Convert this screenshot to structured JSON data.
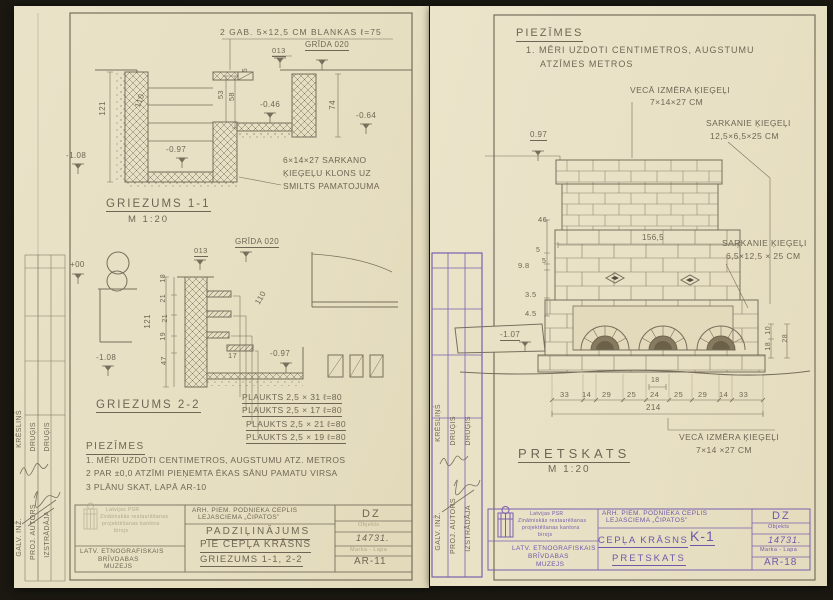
{
  "palette": {
    "paper": "#e9e1c6",
    "pencil": "#6f6655",
    "purple": "#7a5fae",
    "background": "#1a1811"
  },
  "left_sheet": {
    "labels": [
      {
        "n": "note-blankas",
        "t": "2 GAB. 5×12,5 CM BLANKAS ℓ=75",
        "x": 206,
        "y": 22,
        "s": 8.5,
        "ls": 1
      },
      {
        "n": "grida-level-label",
        "t": "GRĪDA 020",
        "x": 291,
        "y": 35,
        "s": 8,
        "u": 1
      },
      {
        "n": "dim-label",
        "t": "013",
        "x": 258,
        "y": 41,
        "s": 7.5,
        "u": 1
      },
      {
        "n": "dim-label",
        "t": "121",
        "x": 85,
        "y": 95,
        "s": 8,
        "cls": "v"
      },
      {
        "n": "dim-label",
        "t": "110",
        "x": 120,
        "y": 100,
        "s": 8,
        "r": -70
      },
      {
        "n": "level-label",
        "t": "-1.08",
        "x": 52,
        "y": 146,
        "s": 8
      },
      {
        "n": "level-label",
        "t": "-0.97",
        "x": 152,
        "y": 140,
        "s": 8
      },
      {
        "n": "dim-label",
        "t": "5",
        "x": 228,
        "y": 62,
        "s": 7,
        "cls": "v"
      },
      {
        "n": "dim-label",
        "t": "53",
        "x": 203,
        "y": 84,
        "s": 7.5,
        "cls": "v"
      },
      {
        "n": "dim-label",
        "t": "58",
        "x": 214,
        "y": 86,
        "s": 7.5,
        "cls": "v"
      },
      {
        "n": "level-label",
        "t": "-0.46",
        "x": 246,
        "y": 95,
        "s": 8
      },
      {
        "n": "dim-label",
        "t": "74",
        "x": 315,
        "y": 94,
        "s": 8,
        "cls": "v"
      },
      {
        "n": "level-label",
        "t": "-0.64",
        "x": 342,
        "y": 106,
        "s": 8
      },
      {
        "n": "note-klons-1",
        "t": "6×14×27 SARKANO",
        "x": 269,
        "y": 150,
        "s": 8.5
      },
      {
        "n": "note-klons-2",
        "t": "ĶIEĢEĻU KLONS UZ",
        "x": 269,
        "y": 163,
        "s": 8.5
      },
      {
        "n": "note-klons-3",
        "t": "SMILTS PAMATOJUMA",
        "x": 269,
        "y": 176,
        "s": 8.5
      },
      {
        "n": "section-title-1-1",
        "t": "GRIEZUMS 1-1",
        "x": 92,
        "y": 192,
        "s": 11.5,
        "ls": 2,
        "u": 1
      },
      {
        "n": "section-scale-1-1",
        "t": "M 1:20",
        "x": 114,
        "y": 209,
        "s": 9.5,
        "ls": 2
      },
      {
        "n": "grida-level-label",
        "t": "GRĪDA 020",
        "x": 221,
        "y": 232,
        "s": 8,
        "u": 1
      },
      {
        "n": "dim-label",
        "t": "013",
        "x": 180,
        "y": 241,
        "s": 7.5,
        "u": 1
      },
      {
        "n": "level-label",
        "t": "+00",
        "x": 56,
        "y": 255,
        "s": 8
      },
      {
        "n": "dim-label",
        "t": "121",
        "x": 130,
        "y": 308,
        "s": 8,
        "cls": "v"
      },
      {
        "n": "dim-label",
        "t": "18",
        "x": 146,
        "y": 268,
        "s": 7,
        "cls": "v"
      },
      {
        "n": "dim-label",
        "t": "21",
        "x": 146,
        "y": 288,
        "s": 7,
        "cls": "v"
      },
      {
        "n": "dim-label",
        "t": "21",
        "x": 148,
        "y": 308,
        "s": 7,
        "cls": "v"
      },
      {
        "n": "dim-label",
        "t": "19",
        "x": 146,
        "y": 326,
        "s": 7,
        "cls": "v"
      },
      {
        "n": "dim-label",
        "t": "47",
        "x": 146,
        "y": 350,
        "s": 7.5,
        "cls": "v"
      },
      {
        "n": "dim-label",
        "t": "110",
        "x": 240,
        "y": 296,
        "s": 8,
        "r": -60
      },
      {
        "n": "level-label",
        "t": "-1.08",
        "x": 82,
        "y": 348,
        "s": 8
      },
      {
        "n": "dim-label",
        "t": "17",
        "x": 214,
        "y": 346,
        "s": 7.5
      },
      {
        "n": "level-label",
        "t": "-0.97",
        "x": 256,
        "y": 344,
        "s": 8
      },
      {
        "n": "shelf-label-1",
        "t": "PLAUKTS 2,5 × 31   ℓ=80",
        "x": 228,
        "y": 387,
        "s": 8.5,
        "u": 1
      },
      {
        "n": "shelf-label-2",
        "t": "PLAUKTS 2,5 × 17   ℓ=80",
        "x": 228,
        "y": 400,
        "s": 8.5,
        "u": 1
      },
      {
        "n": "shelf-label-3",
        "t": "PLAUKTS 2,5 × 21   ℓ=80",
        "x": 232,
        "y": 414,
        "s": 8.5,
        "u": 1
      },
      {
        "n": "shelf-label-4",
        "t": "PLAUKTS 2,5 × 19   ℓ=80",
        "x": 232,
        "y": 427,
        "s": 8.5,
        "u": 1
      },
      {
        "n": "section-title-2-2",
        "t": "GRIEZUMS 2-2",
        "x": 82,
        "y": 393,
        "s": 11.5,
        "ls": 2,
        "u": 1
      },
      {
        "n": "notes-title",
        "t": "PIEZĪMES",
        "x": 72,
        "y": 436,
        "s": 10,
        "ls": 1.5,
        "u": 1
      },
      {
        "n": "note-line-1",
        "t": "1. MĒRI UZDOTI CENTIMETROS, AUGSTUMU ATZ. METROS",
        "x": 72,
        "y": 450,
        "s": 8.5
      },
      {
        "n": "note-line-2",
        "t": "2 PAR ±0,0 ATZĪMI PIEŅEMTA ĒKAS SĀNU PAMATU VIRSA",
        "x": 72,
        "y": 463,
        "s": 8.5
      },
      {
        "n": "note-line-3",
        "t": "3 PLĀNU SKAT, LAPĀ  AR-10",
        "x": 72,
        "y": 477,
        "s": 8.5
      },
      {
        "n": "tb-project-line-1",
        "t": "ARH. PIEM. PODNIEKA CEPLIS",
        "x": 178,
        "y": 502,
        "s": 6.5
      },
      {
        "n": "tb-project-line-2",
        "t": "LEJASCIEMA „ČIPATOS”",
        "x": 184,
        "y": 509,
        "s": 6.5
      },
      {
        "n": "tb-title-1",
        "t": "PADZIĻINĀJUMS",
        "x": 192,
        "y": 521,
        "s": 10,
        "ls": 2,
        "u": 1
      },
      {
        "n": "tb-title-2",
        "t": "PIE CEPĻA KRĀSNS",
        "x": 186,
        "y": 534,
        "s": 10,
        "ls": 1,
        "u": 1
      },
      {
        "n": "tb-title-3",
        "t": "GRIEZUMS 1-1, 2-2",
        "x": 186,
        "y": 549,
        "s": 9.5,
        "ls": 1,
        "u": 1
      },
      {
        "n": "tb-org-1",
        "t": "LATV. ETNOGRAFISKAIS",
        "x": 66,
        "y": 543,
        "s": 6.5
      },
      {
        "n": "tb-org-2",
        "t": "BRĪVDABAS",
        "x": 84,
        "y": 551,
        "s": 6.5
      },
      {
        "n": "tb-org-3",
        "t": "MUZEJS",
        "x": 90,
        "y": 558,
        "s": 6.5
      },
      {
        "n": "tb-dz",
        "t": "DZ",
        "x": 348,
        "y": 503,
        "s": 11,
        "ls": 2
      },
      {
        "n": "tb-objekts-label",
        "t": "Objekts",
        "x": 344,
        "y": 517,
        "s": 5.5,
        "cls": "faint"
      },
      {
        "n": "tb-object-number",
        "t": "14731.",
        "x": 342,
        "y": 528,
        "s": 9,
        "cls": "hand"
      },
      {
        "n": "tb-marka-label",
        "t": "Marka - Lapa",
        "x": 336,
        "y": 542,
        "s": 5.5,
        "cls": "faint"
      },
      {
        "n": "tb-sheet-number",
        "t": "AR-11",
        "x": 340,
        "y": 551,
        "s": 10,
        "ls": 1
      },
      {
        "n": "stamp-line-1",
        "t": "Latvijas PSR",
        "x": 92,
        "y": 502,
        "s": 5,
        "cls": "faint"
      },
      {
        "n": "stamp-line-2",
        "t": "Zinātniskās restaurēšanas",
        "x": 86,
        "y": 509,
        "s": 5,
        "cls": "faint"
      },
      {
        "n": "stamp-line-3",
        "t": "projektēšanas kantora",
        "x": 88,
        "y": 516,
        "s": 5,
        "cls": "faint"
      },
      {
        "n": "stamp-line-4",
        "t": "birojs",
        "x": 100,
        "y": 523,
        "s": 5,
        "cls": "faint"
      },
      {
        "n": "role-galv-inz",
        "t": "GALV. INŽ.",
        "x": 2,
        "y": 512,
        "s": 7,
        "cls": "v"
      },
      {
        "n": "role-proj-autors",
        "t": "PROJ. AUTORS",
        "x": 16,
        "y": 498,
        "s": 7,
        "cls": "v"
      },
      {
        "n": "role-izstradaja",
        "t": "IZSTRĀDĀJA",
        "x": 30,
        "y": 505,
        "s": 7,
        "cls": "v"
      },
      {
        "n": "name-kreslins",
        "t": "KRĒSLIŅŠ",
        "x": 2,
        "y": 404,
        "s": 7,
        "cls": "v"
      },
      {
        "n": "name-drugis-1",
        "t": "DRUĢIS",
        "x": 16,
        "y": 416,
        "s": 7,
        "cls": "v"
      },
      {
        "n": "name-drugis-2",
        "t": "DRUĢIS",
        "x": 30,
        "y": 416,
        "s": 7,
        "cls": "v"
      }
    ]
  },
  "right_sheet": {
    "labels": [
      {
        "n": "notes-title",
        "t": "PIEZĪMES",
        "x": 86,
        "y": 22,
        "s": 11,
        "ls": 2,
        "u": 1
      },
      {
        "n": "note-line-1",
        "t": "1. MĒRI UZDOTI CENTIMETROS, AUGSTUMU",
        "x": 96,
        "y": 40,
        "s": 9,
        "ls": 1
      },
      {
        "n": "note-line-2",
        "t": "ATZĪMES METROS",
        "x": 110,
        "y": 54,
        "s": 9,
        "ls": 1
      },
      {
        "n": "callout-veca-1",
        "t": "VECĀ IZMĒRA ĶIEĢEĻI",
        "x": 200,
        "y": 80,
        "s": 8.5
      },
      {
        "n": "callout-veca-2",
        "t": "7×14×27 CM",
        "x": 220,
        "y": 92,
        "s": 8.5
      },
      {
        "n": "callout-sarkanie-1a",
        "t": "SARKANIE ĶIEĢEĻI",
        "x": 276,
        "y": 113,
        "s": 8.5
      },
      {
        "n": "callout-sarkanie-1b",
        "t": "12,5×6,5×25 CM",
        "x": 280,
        "y": 126,
        "s": 8.5
      },
      {
        "n": "level-label",
        "t": "0.97",
        "x": 100,
        "y": 125,
        "s": 8,
        "u": 1
      },
      {
        "n": "dim-label",
        "t": "156,5",
        "x": 212,
        "y": 228,
        "s": 8
      },
      {
        "n": "callout-sarkanie-2a",
        "t": "SARKANIE ĶIEĢEĻI",
        "x": 292,
        "y": 233,
        "s": 8.5
      },
      {
        "n": "callout-sarkanie-2b",
        "t": "6,5×12,5 × 25 CM",
        "x": 296,
        "y": 246,
        "s": 8.5
      },
      {
        "n": "dim-label",
        "t": "46",
        "x": 108,
        "y": 210,
        "s": 7.5
      },
      {
        "n": "dim-label",
        "t": "5",
        "x": 106,
        "y": 241,
        "s": 7
      },
      {
        "n": "dim-label",
        "t": "5",
        "x": 112,
        "y": 252,
        "s": 7
      },
      {
        "n": "dim-label",
        "t": "9.8",
        "x": 88,
        "y": 256,
        "s": 7.5
      },
      {
        "n": "dim-label",
        "t": "3.5",
        "x": 95,
        "y": 285,
        "s": 7.5
      },
      {
        "n": "dim-label",
        "t": "4.5",
        "x": 95,
        "y": 304,
        "s": 7.5
      },
      {
        "n": "level-label",
        "t": "-1.07",
        "x": 70,
        "y": 325,
        "s": 8,
        "u": 1
      },
      {
        "n": "dim-label",
        "t": "10",
        "x": 335,
        "y": 320,
        "s": 7,
        "cls": "v"
      },
      {
        "n": "dim-label",
        "t": "18",
        "x": 335,
        "y": 336,
        "s": 7,
        "cls": "v"
      },
      {
        "n": "dim-label",
        "t": "28",
        "x": 352,
        "y": 328,
        "s": 7,
        "cls": "v"
      },
      {
        "n": "dim-label",
        "t": "33",
        "x": 130,
        "y": 385,
        "s": 7.5
      },
      {
        "n": "dim-label",
        "t": "14",
        "x": 152,
        "y": 385,
        "s": 7.5
      },
      {
        "n": "dim-label",
        "t": "29",
        "x": 172,
        "y": 385,
        "s": 7.5
      },
      {
        "n": "dim-label",
        "t": "25",
        "x": 197,
        "y": 385,
        "s": 7.5
      },
      {
        "n": "dim-label",
        "t": "24",
        "x": 220,
        "y": 385,
        "s": 7.5
      },
      {
        "n": "dim-label",
        "t": "25",
        "x": 244,
        "y": 385,
        "s": 7.5
      },
      {
        "n": "dim-label",
        "t": "29",
        "x": 268,
        "y": 385,
        "s": 7.5
      },
      {
        "n": "dim-label",
        "t": "14",
        "x": 289,
        "y": 385,
        "s": 7.5
      },
      {
        "n": "dim-label",
        "t": "33",
        "x": 309,
        "y": 385,
        "s": 7.5
      },
      {
        "n": "dim-label",
        "t": "18",
        "x": 221,
        "y": 371,
        "s": 7
      },
      {
        "n": "dim-label",
        "t": "214",
        "x": 216,
        "y": 398,
        "s": 8
      },
      {
        "n": "callout-veca-bottom-1",
        "t": "VECĀ IZMĒRA ĶIEĢEĻI",
        "x": 249,
        "y": 427,
        "s": 8.5
      },
      {
        "n": "callout-veca-bottom-2",
        "t": "7×14 ×27 CM",
        "x": 266,
        "y": 440,
        "s": 8.5
      },
      {
        "n": "view-title",
        "t": "PRETSKATS",
        "x": 88,
        "y": 441,
        "s": 13,
        "ls": 4,
        "u": 1
      },
      {
        "n": "view-scale",
        "t": "M 1:20",
        "x": 118,
        "y": 459,
        "s": 10,
        "ls": 2
      },
      {
        "n": "tb-project-line-1",
        "t": "ARH. PIEM. PODNIEKA CEPLIS",
        "x": 172,
        "y": 505,
        "s": 6.5,
        "cls": "purpleh"
      },
      {
        "n": "tb-project-line-2",
        "t": "LEJASCIEMA „ČIPATOS”",
        "x": 176,
        "y": 512,
        "s": 6.5,
        "cls": "purpleh"
      },
      {
        "n": "tb-title-1",
        "t": "CEPĻA KRĀSNS",
        "x": 168,
        "y": 530,
        "s": 9.5,
        "ls": 1.5,
        "u": 1,
        "cls": "purpleh"
      },
      {
        "n": "tb-title-k1",
        "t": "K-1",
        "x": 260,
        "y": 523,
        "s": 14,
        "ls": 1,
        "u": 1,
        "cls": "purpleh"
      },
      {
        "n": "tb-title-2",
        "t": "PRETSKATS",
        "x": 182,
        "y": 548,
        "s": 9.5,
        "ls": 2,
        "u": 1,
        "cls": "purpleh"
      },
      {
        "n": "tb-dz",
        "t": "DZ",
        "x": 342,
        "y": 505,
        "s": 11,
        "ls": 2,
        "cls": "purpleh"
      },
      {
        "n": "tb-objekts-label",
        "t": "Objekts",
        "x": 338,
        "y": 519,
        "s": 5.5,
        "cls": "purpleh"
      },
      {
        "n": "tb-object-number",
        "t": "14731.",
        "x": 338,
        "y": 530,
        "s": 9,
        "cls": "hand purpleh"
      },
      {
        "n": "tb-marka-label",
        "t": "Marka - Lapa",
        "x": 330,
        "y": 542,
        "s": 5.5,
        "cls": "purpleh"
      },
      {
        "n": "tb-sheet-number",
        "t": "AR-18",
        "x": 334,
        "y": 552,
        "s": 10,
        "ls": 1,
        "cls": "purpleh"
      },
      {
        "n": "tb-org-1",
        "t": "LATV. ETNOGRAFISKAIS",
        "x": 82,
        "y": 540,
        "s": 6.5,
        "cls": "purpleh"
      },
      {
        "n": "tb-org-2",
        "t": "BRĪVDABAS",
        "x": 98,
        "y": 548,
        "s": 6.5,
        "cls": "purpleh"
      },
      {
        "n": "tb-org-3",
        "t": "MUZEJS",
        "x": 106,
        "y": 556,
        "s": 6.5,
        "cls": "purpleh"
      },
      {
        "n": "stamp-line-1",
        "t": "Latvijas PSR",
        "x": 100,
        "y": 506,
        "s": 5,
        "cls": "purpleh"
      },
      {
        "n": "stamp-line-2",
        "t": "Zinātniskās restaurēšanas",
        "x": 88,
        "y": 513,
        "s": 5,
        "cls": "purpleh"
      },
      {
        "n": "stamp-line-3",
        "t": "projektēšanas kantora",
        "x": 92,
        "y": 520,
        "s": 5,
        "cls": "purpleh"
      },
      {
        "n": "stamp-line-4",
        "t": "birojs",
        "x": 108,
        "y": 527,
        "s": 5,
        "cls": "purpleh"
      },
      {
        "n": "role-galv-inz",
        "t": "GALV. INŽ.",
        "x": 5,
        "y": 506,
        "s": 7,
        "cls": "v"
      },
      {
        "n": "role-proj-autors",
        "t": "PROJ. AUTORS",
        "x": 20,
        "y": 492,
        "s": 7,
        "cls": "v"
      },
      {
        "n": "role-izstradaja",
        "t": "IZSTRĀDĀJA",
        "x": 35,
        "y": 499,
        "s": 7,
        "cls": "v"
      },
      {
        "n": "name-kreslins",
        "t": "KRĒSLIŅŠ",
        "x": 5,
        "y": 398,
        "s": 7,
        "cls": "v"
      },
      {
        "n": "name-drugis-1",
        "t": "DRUĢIS",
        "x": 20,
        "y": 410,
        "s": 7,
        "cls": "v"
      },
      {
        "n": "name-drugis-2",
        "t": "DRUĢIS",
        "x": 35,
        "y": 410,
        "s": 7,
        "cls": "v"
      }
    ]
  }
}
